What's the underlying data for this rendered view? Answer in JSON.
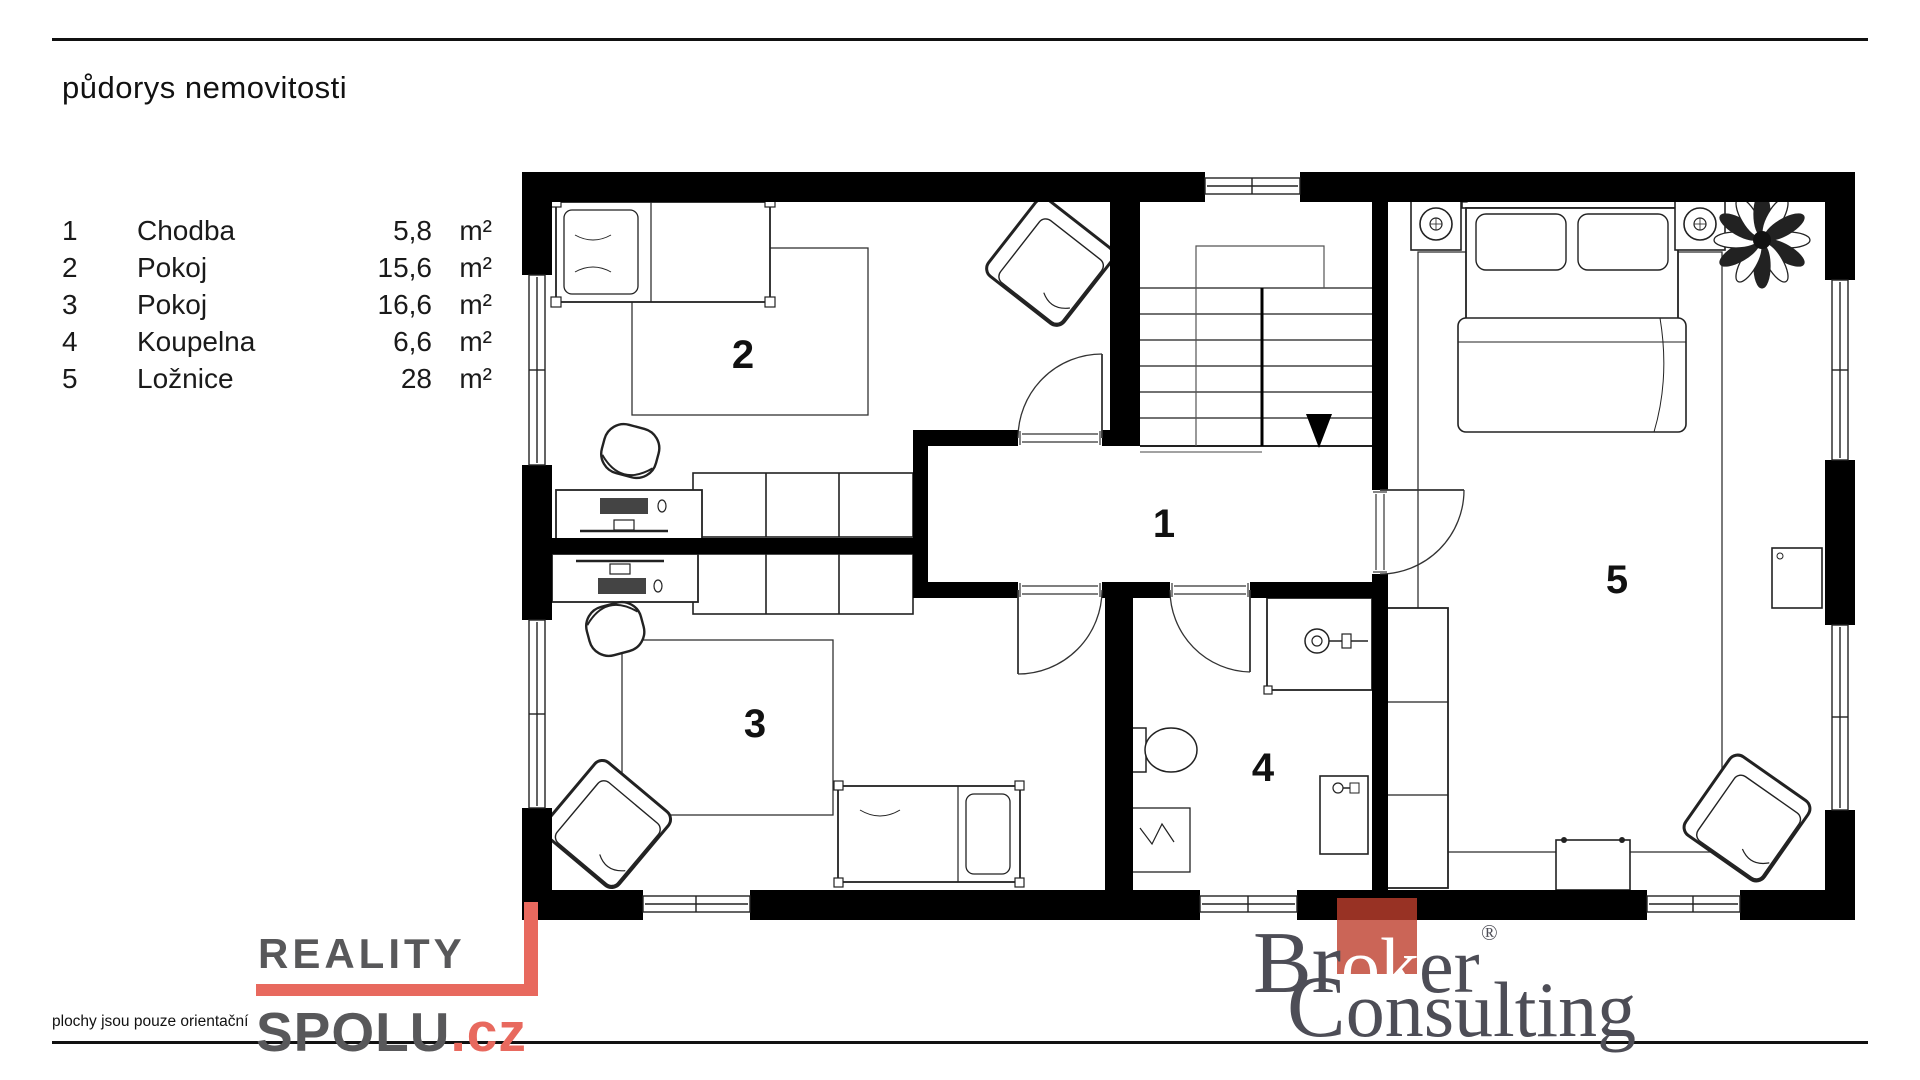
{
  "page": {
    "title": "půdorys nemovitosti",
    "footnote": "plochy jsou pouze orientační"
  },
  "legend": {
    "rows": [
      {
        "number": "1",
        "name": "Chodba",
        "area": "5,8",
        "unit": "m²"
      },
      {
        "number": "2",
        "name": "Pokoj",
        "area": "15,6",
        "unit": "m²"
      },
      {
        "number": "3",
        "name": "Pokoj",
        "area": "16,6",
        "unit": "m²"
      },
      {
        "number": "4",
        "name": "Koupelna",
        "area": "6,6",
        "unit": "m²"
      },
      {
        "number": "5",
        "name": "Ložnice",
        "area": "28",
        "unit": "m²"
      }
    ]
  },
  "plan": {
    "rooms": [
      {
        "number": "1",
        "name": "Chodba"
      },
      {
        "number": "2",
        "name": "Pokoj"
      },
      {
        "number": "3",
        "name": "Pokoj"
      },
      {
        "number": "4",
        "name": "Koupelna"
      },
      {
        "number": "5",
        "name": "Ložnice"
      }
    ]
  },
  "footer": {
    "reality": {
      "word1": "REALITY",
      "word2": "SPOLU",
      "tld": ".cz"
    },
    "broker": {
      "pre": "Br",
      "mid": "ok",
      "post": "er",
      "registered": "®",
      "line2_pre": "C",
      "line2_rest": "onsulting"
    }
  },
  "colors": {
    "wall": "#000000",
    "reality_gray": "#58585a",
    "reality_red": "#e8695e",
    "broker_gray": "#4d4d56",
    "broker_red": "#be3e2d"
  }
}
